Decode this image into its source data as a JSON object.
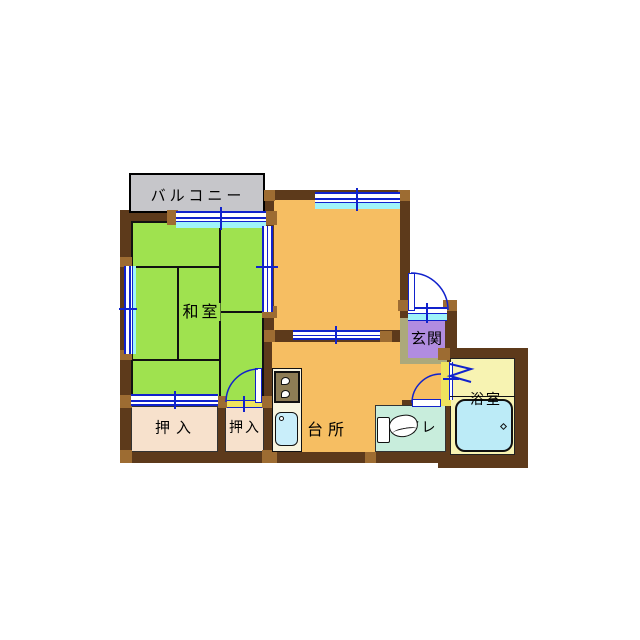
{
  "type": "floorplan",
  "rooms": {
    "balcony": {
      "label": "バルコニー",
      "color": "#c6c6ca"
    },
    "washitsu": {
      "label": "和室",
      "color": "#9fe24f"
    },
    "kitchen": {
      "label": "台所",
      "color": "#f6be62"
    },
    "dining_room": {
      "label": "",
      "color": "#f6be62"
    },
    "genkan": {
      "label": "玄関",
      "color": "#b18ce0"
    },
    "closet_left": {
      "label": "押入",
      "color": "#f7e1cc"
    },
    "closet_right": {
      "label": "押入",
      "color": "#f7e1cc"
    },
    "toilet": {
      "label": "トイレ",
      "color": "#c8eddc"
    },
    "bathroom": {
      "label": "浴室",
      "color": "#f7f3b2"
    }
  },
  "palette": {
    "wall": "#5d3a1b",
    "wall_post": "#9d6c32",
    "window_frame": "#1122cc",
    "window_glass": "#9ff3f9",
    "door_threshold": "#efe35e",
    "entry_step": "#aca97b",
    "counter": "#f8f4df",
    "stove": "#8d7c55",
    "sink": "#c9eefa",
    "bathtub": "#bcebf7",
    "balcony_floor": "#c6c6ca"
  },
  "fixtures": [
    "stove",
    "kitchen-sink",
    "toilet-bowl",
    "bathtub"
  ]
}
